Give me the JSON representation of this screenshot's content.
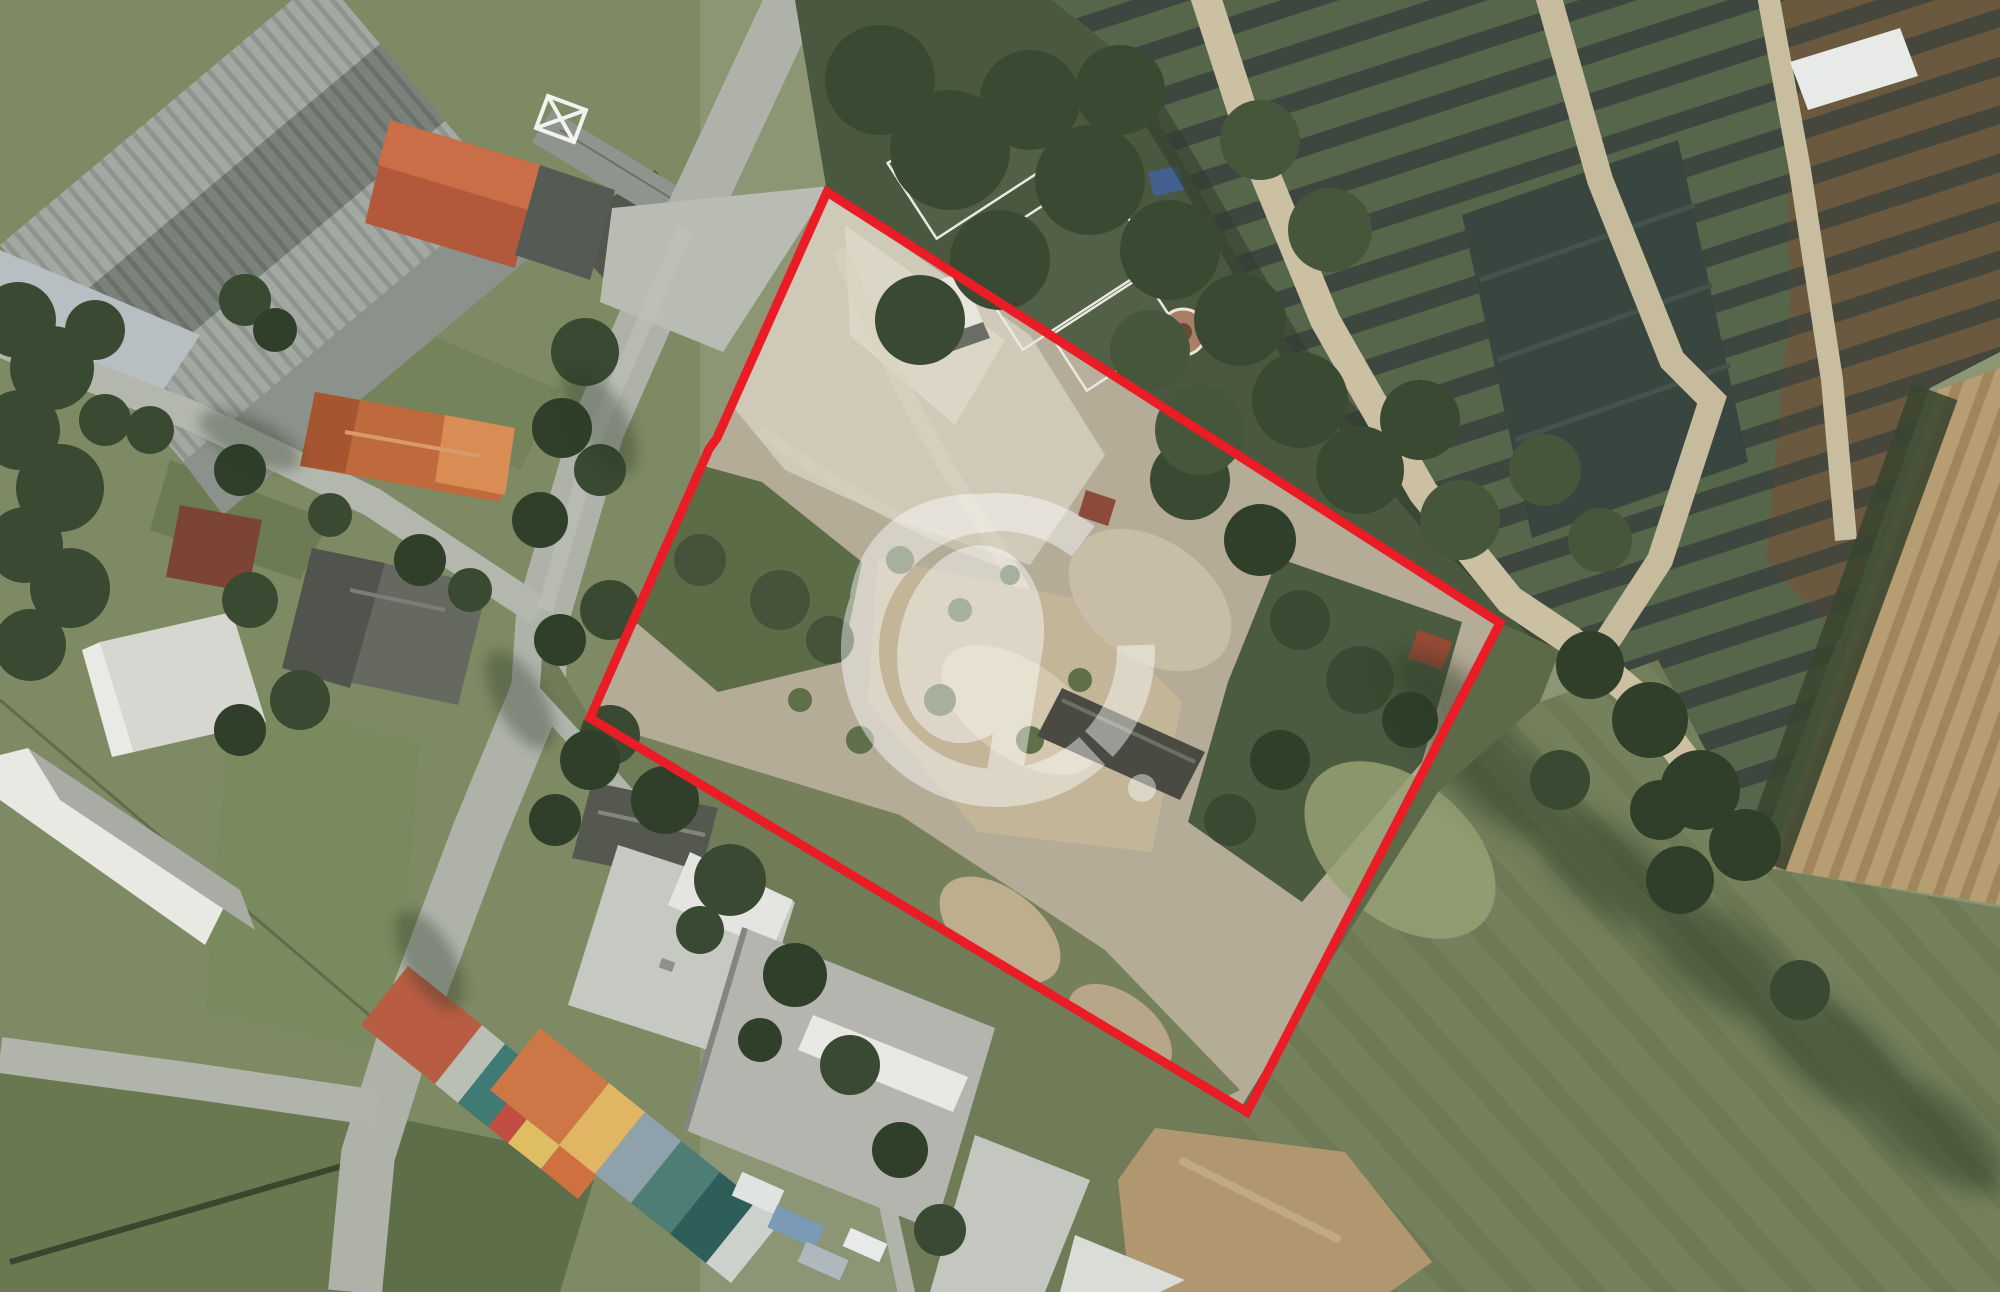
{
  "image": {
    "kind": "aerial-orthophoto-listing",
    "width_px": 2000,
    "height_px": 1292,
    "description": "Top-down aerial photograph of a vacant development plot outlined in red, surrounded by houses, industrial roofs, a plant nursery, plowed strip and green field; translucent white logo watermark in the centre"
  },
  "boundary": {
    "points": "827,192 717,438 709,449 590,718 1247,1112 1500,623",
    "color": "#ea1c25",
    "stroke_width": 9
  },
  "watermark": {
    "color": "#ffffff",
    "opacity": 0.45,
    "center_x": 998,
    "center_y": 650,
    "ring_radius": 138,
    "ring_stroke": 38,
    "dot_x": 144,
    "dot_y": 138,
    "dot_r": 14
  },
  "scene": {
    "palette": {
      "base_green": "#8d9674",
      "road_gray": "#aeb2a9",
      "concrete": "#cfc9b8",
      "bare_dirt": "#c2b598",
      "scrub_green": "#5c6c47",
      "tree_dark": "#3a4a32",
      "roof_orange": "#bf6a3c",
      "roof_gray_industrial": "#8b918b",
      "warehouse_white": "#c6c8c2",
      "nursery_row_green": "#55664a",
      "nursery_row_brown": "#6a593f",
      "shade_cloth": "#39463f",
      "plowed_field": "#b79d72",
      "meadow": "#74815c",
      "dirt_road": "#ccc0a2"
    },
    "regions": [
      {
        "name": "industrial-roofs",
        "position": "top-left"
      },
      {
        "name": "residential-houses",
        "position": "left"
      },
      {
        "name": "streets",
        "position": "left-diagonal"
      },
      {
        "name": "property-parcel",
        "position": "center",
        "state": "vacant, part concrete, part scrub"
      },
      {
        "name": "garden-allotments",
        "position": "top-center"
      },
      {
        "name": "plant-nursery",
        "position": "top-right"
      },
      {
        "name": "plowed-field",
        "position": "right"
      },
      {
        "name": "meadow-field",
        "position": "bottom-right"
      },
      {
        "name": "colorful-sheds",
        "position": "bottom-left"
      },
      {
        "name": "warehouse-buildings",
        "position": "bottom-center"
      }
    ]
  }
}
